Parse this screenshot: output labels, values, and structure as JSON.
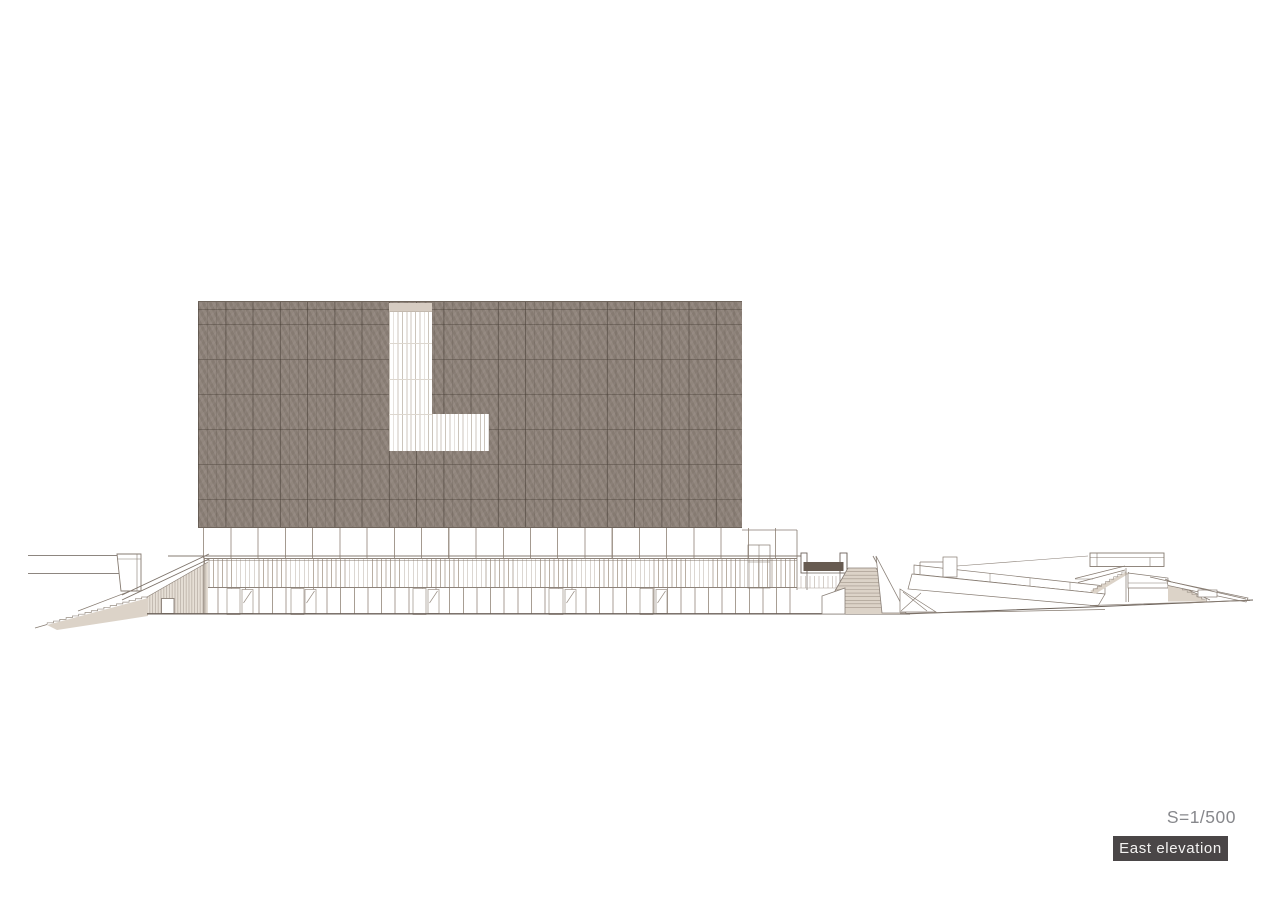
{
  "annotation": {
    "scale_label": "S=1/500",
    "title": "East elevation"
  },
  "drawing": {
    "glazing_motif": "L",
    "elements": [
      "facade-block",
      "l-shaped-glazing",
      "colonnade",
      "louver-band",
      "base-level",
      "left-grand-stair",
      "stair-kiosk",
      "entry-notch",
      "fan-stair",
      "ramp-complex",
      "terraced-stand"
    ]
  },
  "palette": {
    "background": "#ffffff",
    "facade": "#8b7f76",
    "facade_grid": "#6f655c",
    "glazing_white": "#ffffff",
    "glazing_mullion": "#ccc5bc",
    "glazing_top_band": "#d6ccc2",
    "line": "#867b71",
    "line_dark": "#6b6159",
    "stair_fill": "#dcd3c8",
    "dark_accent": "#675b51",
    "label_bg": "#4a4647",
    "label_text": "#f4f3f2",
    "scale_text": "#87888c"
  }
}
